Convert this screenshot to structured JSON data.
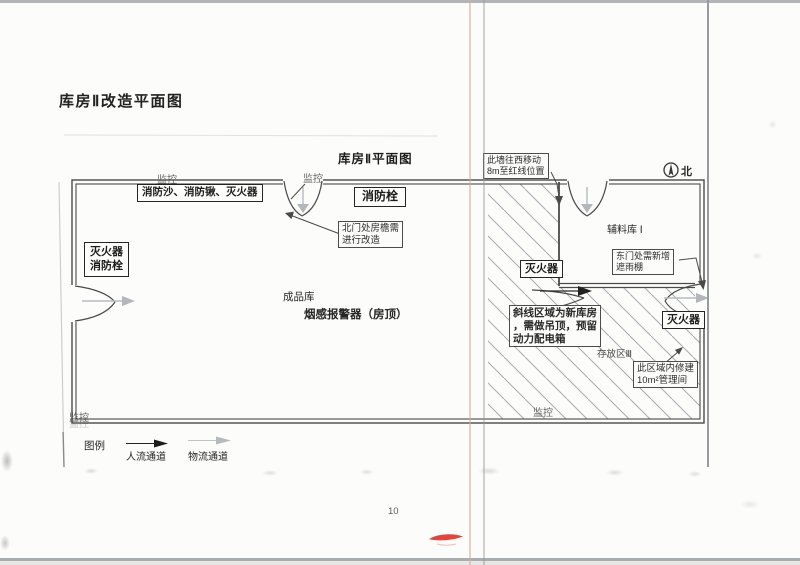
{
  "page": {
    "heading": "库房Ⅱ改造平面图",
    "page_number": "10"
  },
  "diagram": {
    "title": "库房Ⅱ平面图",
    "north_label": "北",
    "monitor_label": "监控",
    "rooms": {
      "finished_goods": "成品库",
      "smoke_detector_note": "烟感报警器（房顶）",
      "auxiliary_storage": "辅料库 Ⅰ",
      "storage_area_3": "存放区Ⅲ"
    },
    "fire_equipment": {
      "sand_shovel_ext": "消防沙、消防锹、灭火器",
      "hydrant": "消防栓",
      "west_ext_line1": "灭火器",
      "west_ext_line2": "消防栓",
      "mid_ext": "灭火器",
      "east_ext": "灭火器"
    },
    "callouts": {
      "wall_move_line1": "此墙往西移动",
      "wall_move_line2": "8m至红线位置",
      "north_door_line1": "北门处房檐需",
      "north_door_line2": "进行改造",
      "east_door_line1": "东门处需新增",
      "east_door_line2": "遮雨棚",
      "hatch_note_line1": "斜线区域为新库房",
      "hatch_note_line2": "，需做吊顶，预留",
      "hatch_note_line3": "动力配电箱",
      "mgmt_room_line1": "此区域内修建",
      "mgmt_room_line2": "10m²管理间"
    }
  },
  "legend": {
    "title": "图例",
    "people_flow": "人流通道",
    "logistics_flow": "物流通道"
  },
  "colors": {
    "red_mark": "#e23429",
    "hatch_line": "#a5abb1",
    "wall": "#4a4a4a",
    "gray_flow": "#b8bcc0"
  }
}
